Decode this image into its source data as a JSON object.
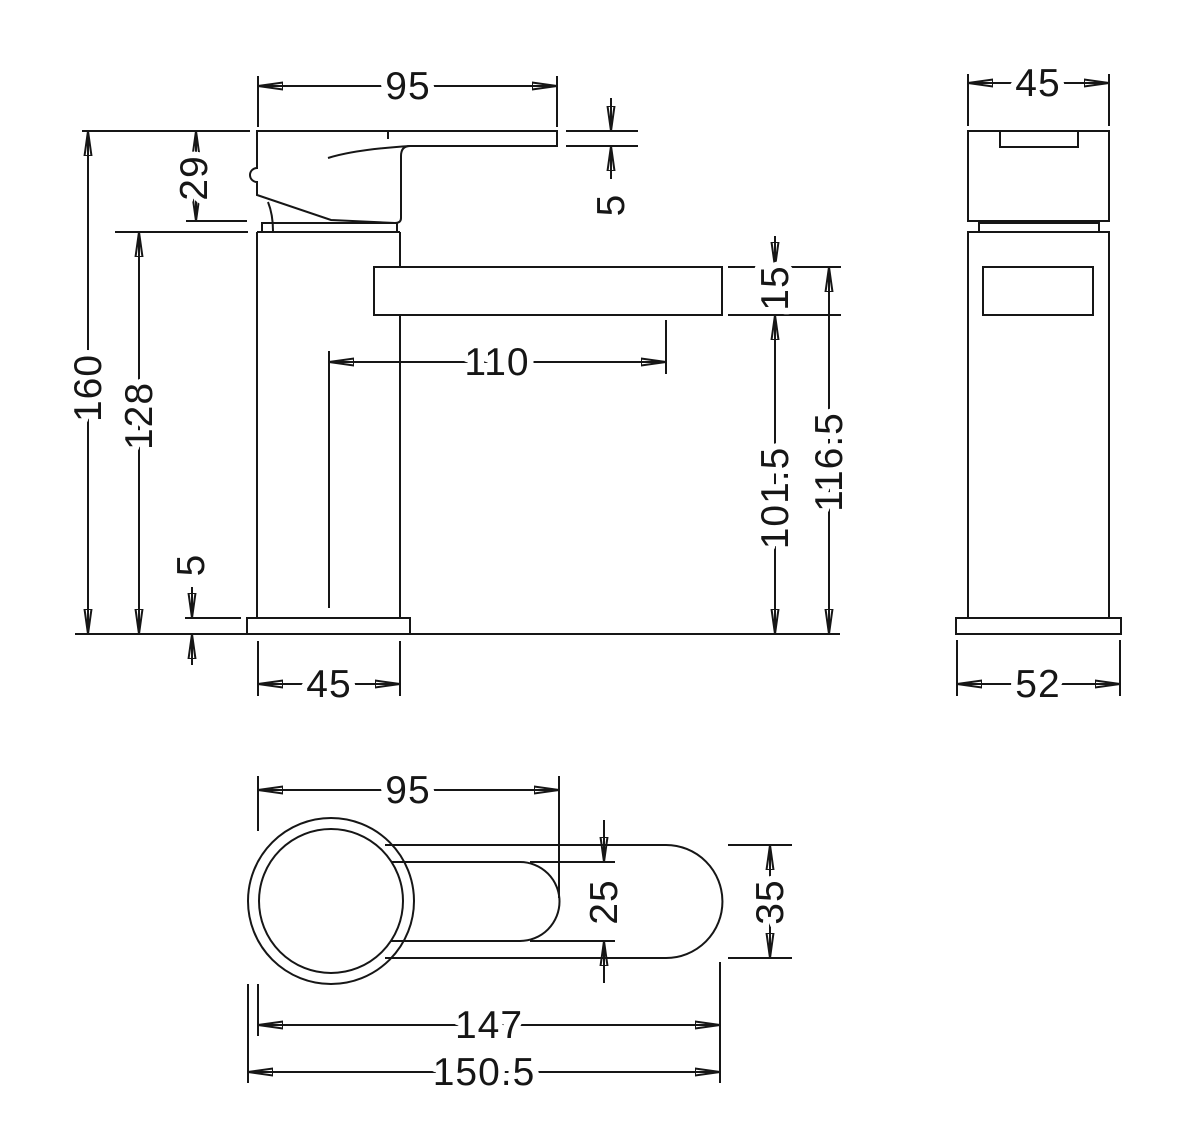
{
  "canvas": {
    "background": "#ffffff",
    "line_color": "#161616"
  },
  "views": {
    "front": {
      "dims": {
        "top_width": "95",
        "lever_thickness": "5",
        "handle_height": "29",
        "overall_height": "160",
        "body_height": "128",
        "spout_reach": "110",
        "spout_thickness": "15",
        "spout_underside_height": "101.5",
        "spout_top_height": "116.5",
        "base_plate_thickness": "5",
        "body_width": "45"
      }
    },
    "side": {
      "dims": {
        "body_depth": "45",
        "base_depth": "52"
      }
    },
    "plan": {
      "dims": {
        "handle_reach": "95",
        "handle_width": "25",
        "body_width": "35",
        "spout_length": "147",
        "overall_length": "150.5"
      }
    }
  }
}
